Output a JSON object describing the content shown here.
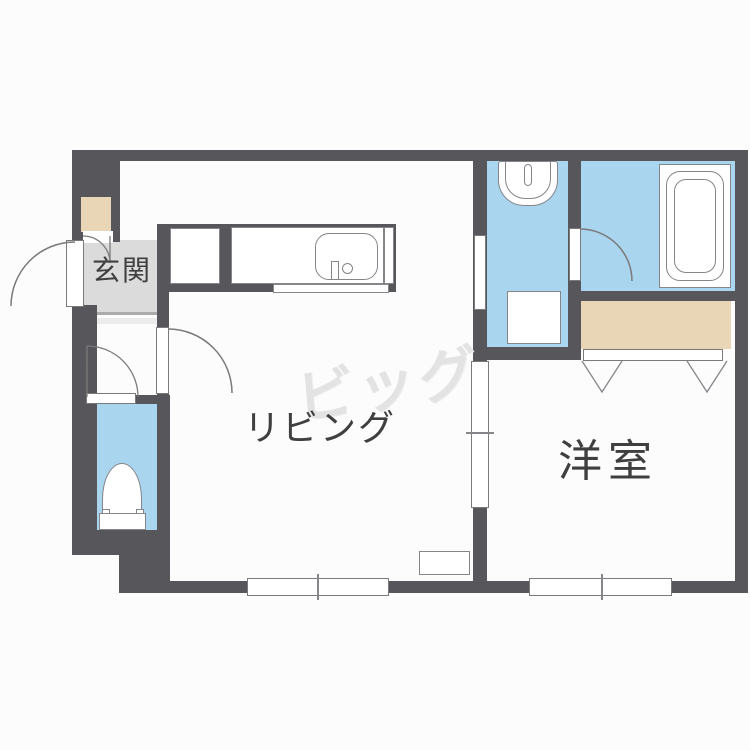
{
  "floorplan": {
    "type": "apartment-floor-plan",
    "watermark": {
      "text": "ビッグ",
      "color": "#e3e3e3"
    },
    "rooms": {
      "genkan": {
        "label": "玄関"
      },
      "living": {
        "label": "リビング"
      },
      "western": {
        "label": "洋室"
      }
    },
    "fixtures": [
      "entrance-door",
      "shoe-cabinet",
      "kitchen-counter",
      "kitchen-sink",
      "kitchen-faucet",
      "washbasin",
      "washing-machine-pan",
      "bathtub",
      "toilet",
      "closet",
      "closet-folding-doors",
      "sliding-door",
      "hinged-doors",
      "windows"
    ],
    "colors": {
      "wall": "#56565b",
      "water_area": "#a9d5ef",
      "closet_area": "#e9d6b7",
      "genkan_floor": "#dbdbdb",
      "room_floor": "#fefefe",
      "label_text": "#3f3f3f"
    }
  }
}
